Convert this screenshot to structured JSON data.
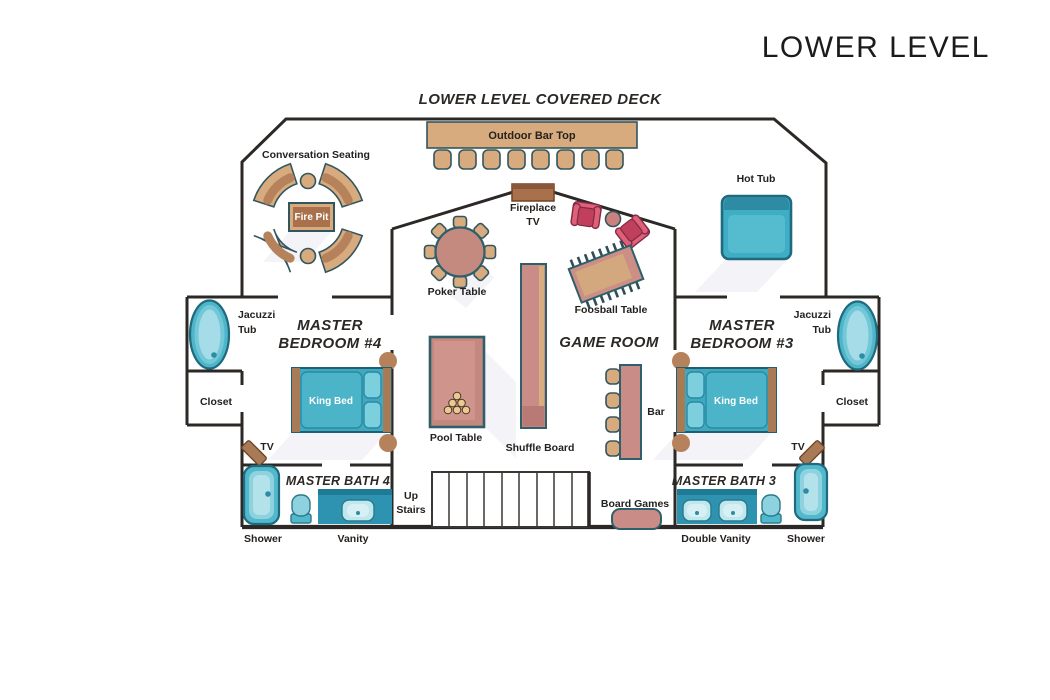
{
  "title": "LOWER LEVEL",
  "deck": {
    "title": "LOWER LEVEL COVERED DECK",
    "outdoor_bar_top": "Outdoor Bar Top",
    "conversation_seating": "Conversation Seating",
    "fire_pit": "Fire Pit",
    "fireplace_line1": "Fireplace",
    "fireplace_line2": "TV",
    "hot_tub": "Hot Tub"
  },
  "game_room": {
    "name": "GAME ROOM",
    "poker_table": "Poker Table",
    "foosball_table": "Foosball Table",
    "pool_table": "Pool Table",
    "shuffle_board": "Shuffle Board",
    "bar": "Bar",
    "board_games": "Board Games",
    "up_stairs_line1": "Up",
    "up_stairs_line2": "Stairs"
  },
  "bedroom4": {
    "name_line1": "MASTER",
    "name_line2": "BEDROOM #4",
    "bath_name": "MASTER BATH 4",
    "vanity": "Vanity"
  },
  "bedroom3": {
    "name_line1": "MASTER",
    "name_line2": "BEDROOM #3",
    "bath_name": "MASTER BATH 3",
    "double_vanity": "Double Vanity"
  },
  "fixtures": {
    "jacuzzi_line1": "Jacuzzi",
    "jacuzzi_line2": "Tub",
    "closet": "Closet",
    "king_bed": "King Bed",
    "tv": "TV",
    "shower": "Shower"
  },
  "colors": {
    "wall": "#2b2826",
    "tan": "#d8ab7e",
    "brown": "#a9714b",
    "rose": "#c98c86",
    "teal": "#43aec5",
    "teal_dark": "#2d8ba3",
    "teal_light": "#a5dce8",
    "pink_chair": "#d6566f",
    "vanity_teal": "#2e93b0",
    "furniture_outline": "#2e5f6b"
  }
}
